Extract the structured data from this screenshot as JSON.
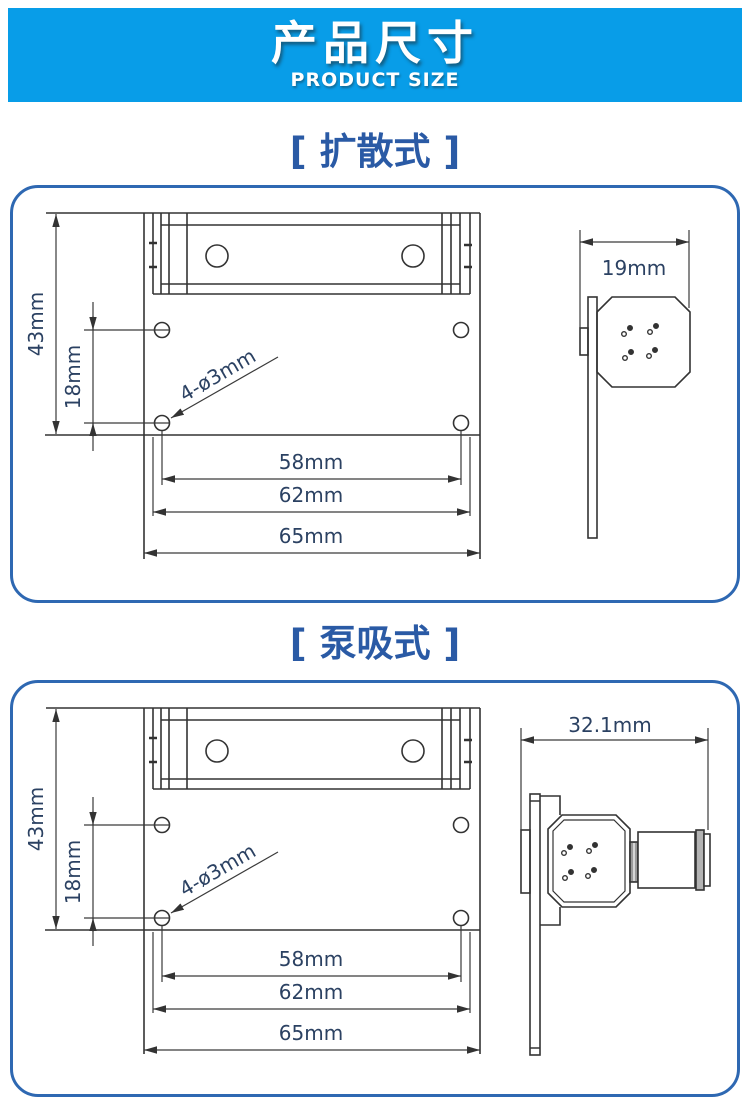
{
  "header": {
    "title": "产品尺寸",
    "subtitle": "PRODUCT SIZE"
  },
  "colors": {
    "banner_blue": "#089de8",
    "panel_border_blue": "#2e68b2",
    "section_title_blue": "#2a5aa5",
    "dimension_text_navy": "#2b4162",
    "drawing_line": "#333333"
  },
  "sections": [
    {
      "label": "[ 扩散式 ]",
      "front": {
        "height": "43mm",
        "hole_spacing": "18mm",
        "holes": "4-ø3mm",
        "inner_width": "58mm",
        "mid_width": "62mm",
        "full_width": "65mm"
      },
      "side": {
        "depth": "19mm"
      }
    },
    {
      "label": "[ 泵吸式 ]",
      "front": {
        "height": "43mm",
        "hole_spacing": "18mm",
        "holes": "4-ø3mm",
        "inner_width": "58mm",
        "mid_width": "62mm",
        "full_width": "65mm"
      },
      "side": {
        "depth": "32.1mm"
      }
    }
  ]
}
